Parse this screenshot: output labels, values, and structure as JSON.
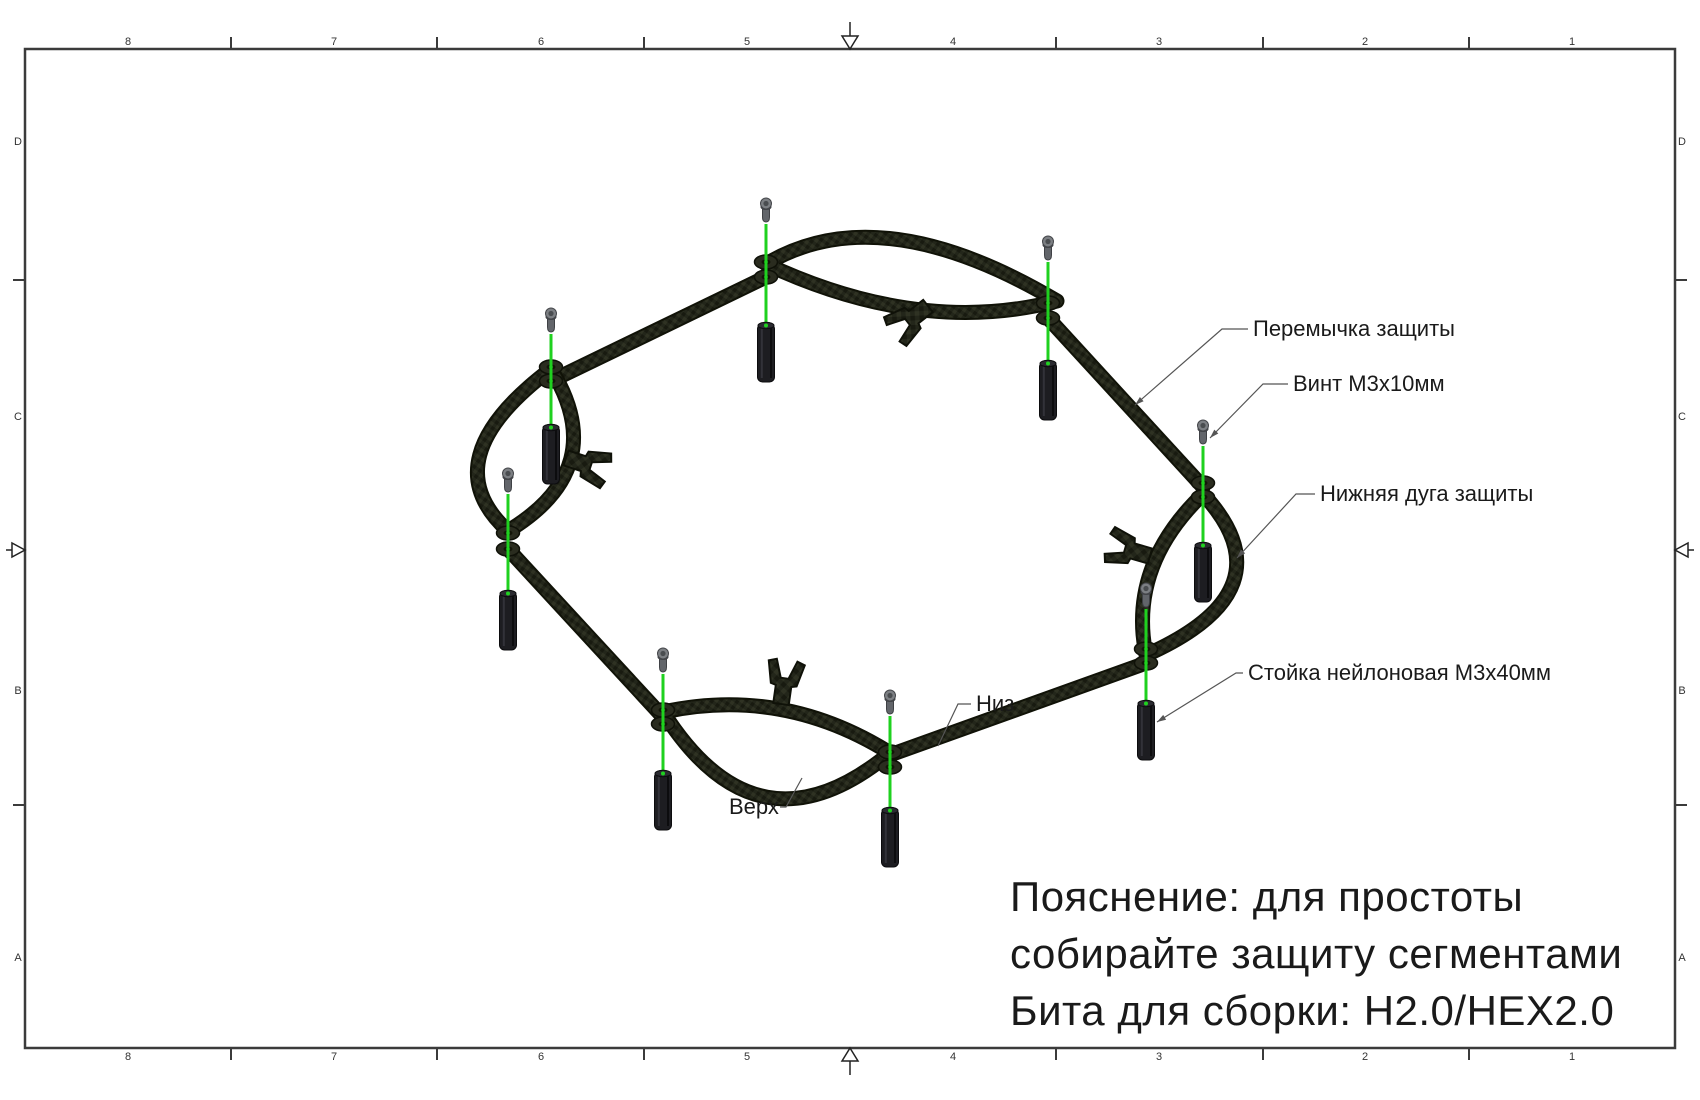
{
  "document": {
    "type": "assembly-drawing"
  },
  "border": {
    "cols": [
      "8",
      "7",
      "6",
      "5",
      "4",
      "3",
      "2",
      "1"
    ],
    "rows": [
      "D",
      "C",
      "B",
      "A"
    ]
  },
  "callouts": {
    "peremychka": "Перемычка защиты",
    "vint": "Винт M3x10мм",
    "duga": "Нижняя дуга защиты",
    "stoyka": "Стойка нейлоновая M3x40мм",
    "niz": "Низ",
    "verh": "Верх"
  },
  "note": {
    "line1": "Пояснение: для простоты",
    "line2": "собирайте защиту сегментами",
    "line3": "Бита для сборки: H2.0/HEX2.0"
  },
  "colors": {
    "alignment_green": "#1fd11f",
    "carbon_dark": "#101207",
    "frame": "#3b3b3b",
    "leader": "#555555"
  }
}
